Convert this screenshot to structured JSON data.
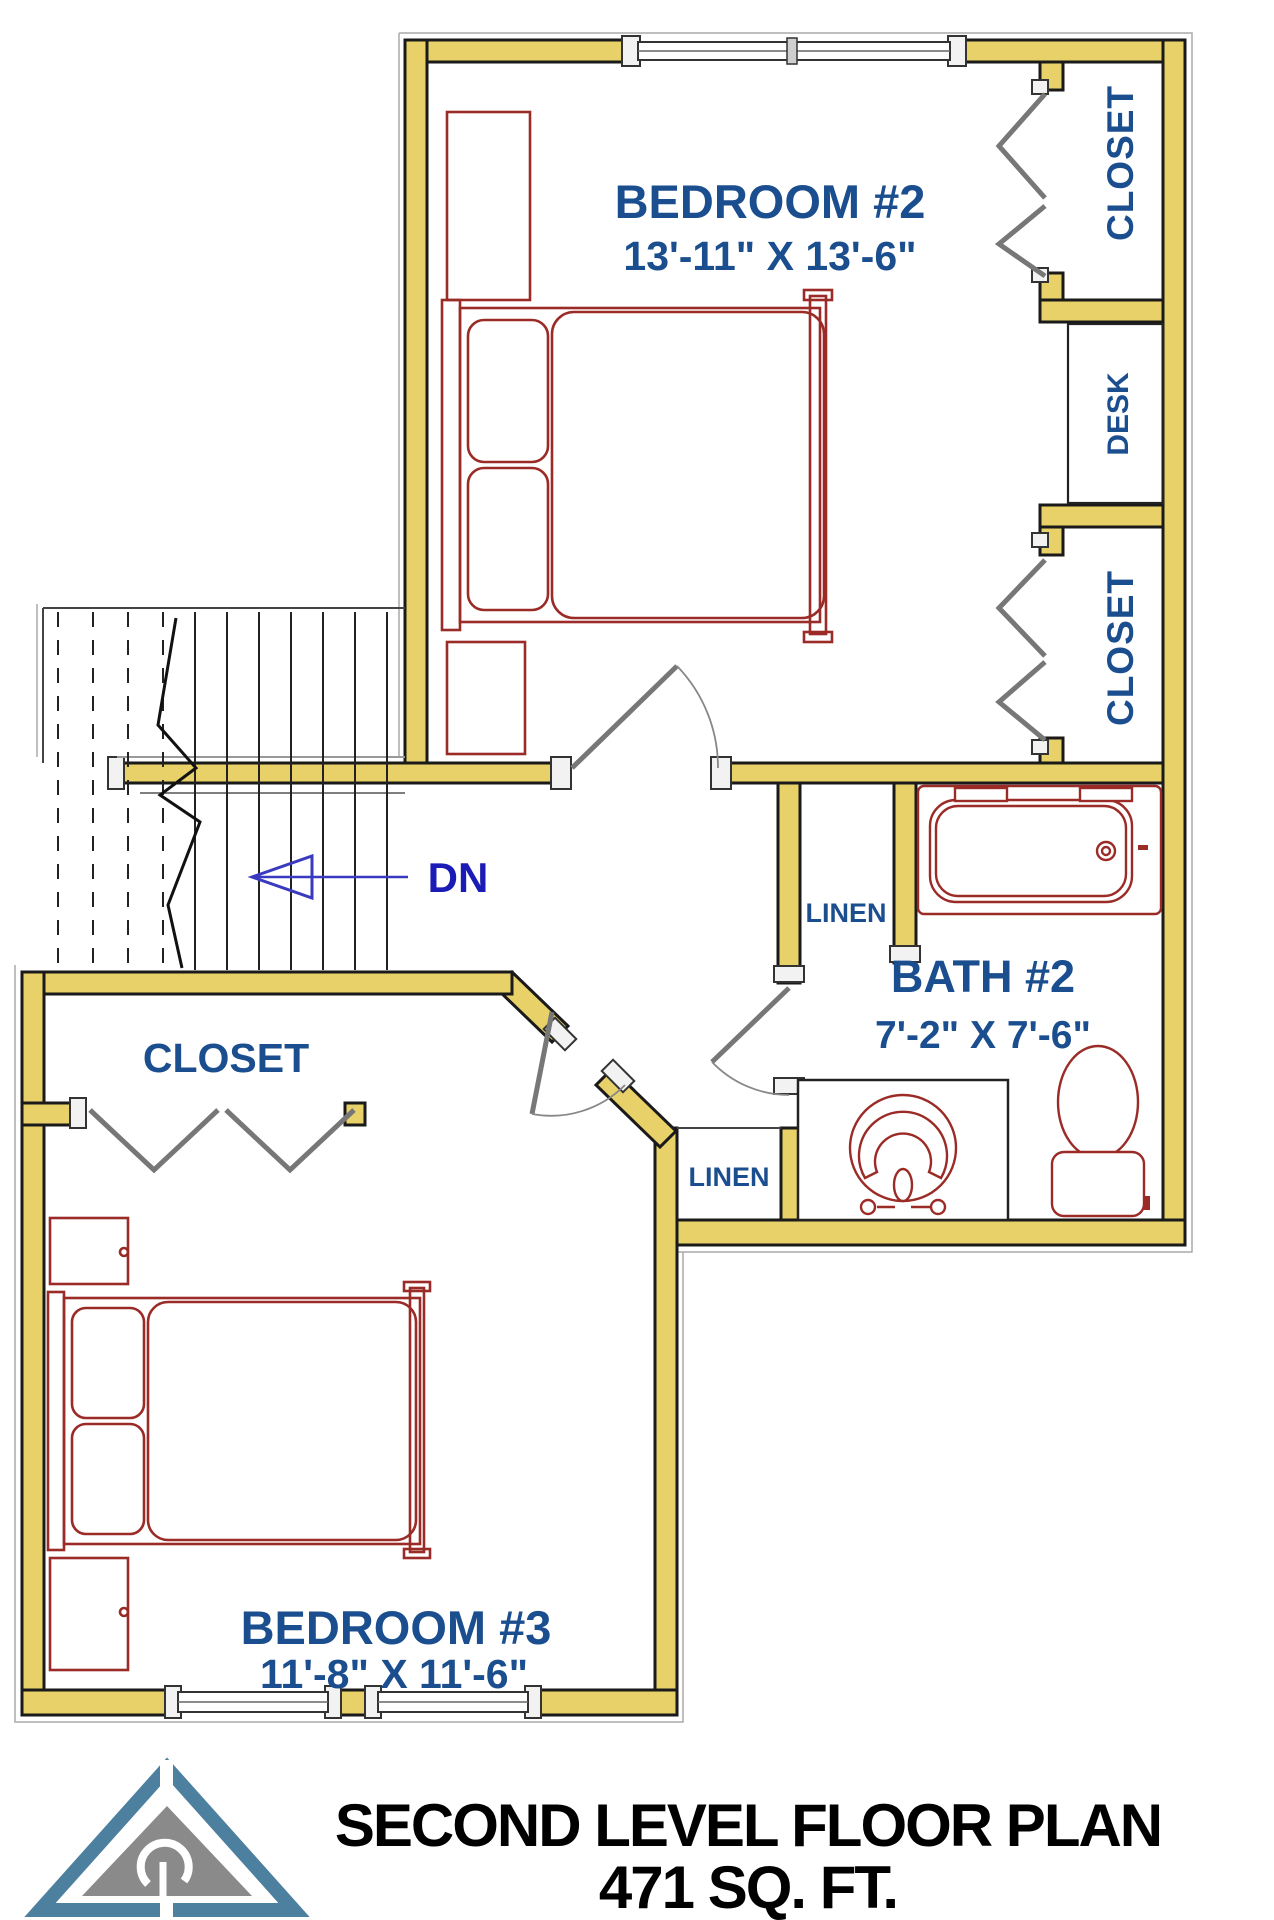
{
  "plan": {
    "rooms": {
      "bedroom2": {
        "name": "BEDROOM #2",
        "dims": "13'-11\" X 13'-6\""
      },
      "bedroom3": {
        "name": "BEDROOM #3",
        "dims": "11'-8\" X 11'-6\""
      },
      "bath2": {
        "name": "BATH #2",
        "dims": "7'-2\" X 7'-6\""
      }
    },
    "closets": {
      "closet1": "CLOSET",
      "closet2": "CLOSET",
      "closet3": "CLOSET",
      "desk": "DESK",
      "linen1": "LINEN",
      "linen2": "LINEN"
    },
    "stairs": {
      "down_label": "DN"
    }
  },
  "title": {
    "line1": "SECOND LEVEL FLOOR PLAN",
    "line2": "471 SQ. FT."
  },
  "colors": {
    "wall_fill": "#E7D168",
    "wall_stroke": "#1a1a1a",
    "label_blue": "#1B4E8E",
    "furniture_red": "#9B2B26",
    "dn_navy": "#1b1bb5",
    "logo_blue": "#4D7F9E",
    "logo_gray": "#8A8A8A",
    "title_black": "#000000"
  }
}
